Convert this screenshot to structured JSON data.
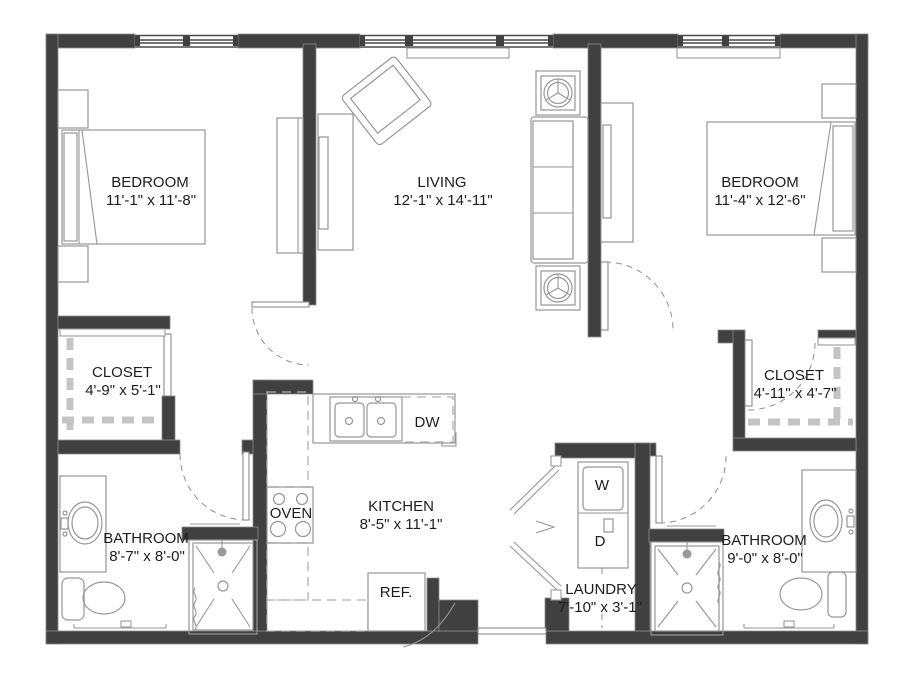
{
  "rooms": {
    "bedroom1": {
      "name": "BEDROOM",
      "dims": "11'-1\" x 11'-8\""
    },
    "living": {
      "name": "LIVING",
      "dims": "12'-1\" x 14'-11\""
    },
    "bedroom2": {
      "name": "BEDROOM",
      "dims": "11'-4\" x 12'-6\""
    },
    "closet1": {
      "name": "CLOSET",
      "dims": "4'-9\" x 5'-1\""
    },
    "closet2": {
      "name": "CLOSET",
      "dims": "4'-11\" x 4'-7\""
    },
    "bathroom1": {
      "name": "BATHROOM",
      "dims": "8'-7\" x 8'-0\""
    },
    "kitchen": {
      "name": "KITCHEN",
      "dims": "8'-5\" x 11'-1\""
    },
    "laundry": {
      "name": "LAUNDRY",
      "dims": "7'-10\" x 3'-1\""
    },
    "bathroom2": {
      "name": "BATHROOM",
      "dims": "9'-0\" x 8'-0\""
    }
  },
  "appliances": {
    "dishwasher": "DW",
    "oven": "OVEN",
    "refrigerator": "REF.",
    "washer": "W",
    "dryer": "D"
  },
  "colors": {
    "wall": "#404040",
    "line": "#979797",
    "text": "#1d1d1d",
    "background": "#ffffff"
  }
}
